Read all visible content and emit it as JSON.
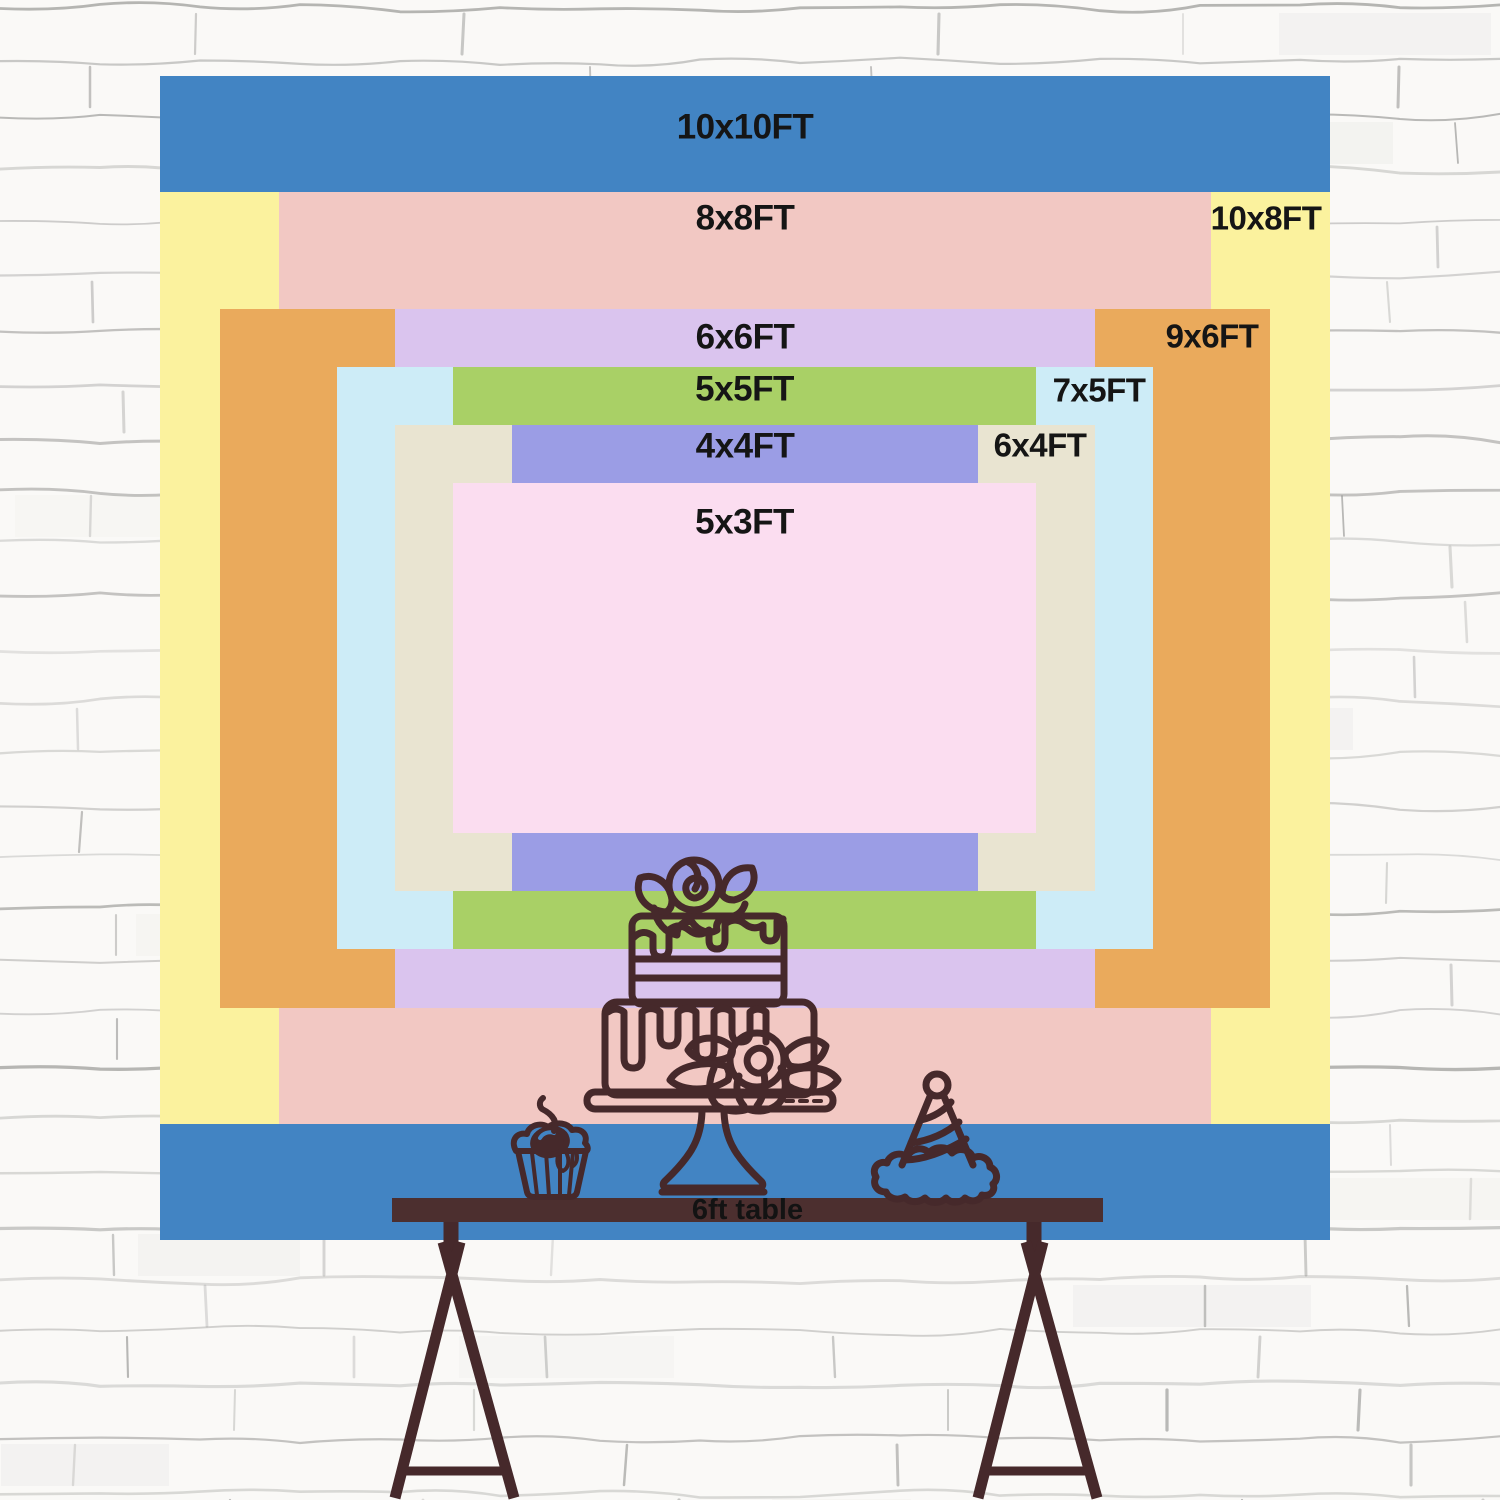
{
  "backdrop": {
    "layers": [
      {
        "name": "10x10ft",
        "label": "10x10FT",
        "color": "#4284c3",
        "label_position": "top-center"
      },
      {
        "name": "10x8ft",
        "label": "10x8FT",
        "color": "#fbf29e",
        "label_position": "top-right"
      },
      {
        "name": "8x8ft",
        "label": "8x8FT",
        "color": "#f2c8c3",
        "label_position": "top-center"
      },
      {
        "name": "9x6ft",
        "label": "9x6FT",
        "color": "#eaaa5c",
        "label_position": "top-right"
      },
      {
        "name": "6x6ft",
        "label": "6x6FT",
        "color": "#dac4ee",
        "label_position": "top-center"
      },
      {
        "name": "7x5ft",
        "label": "7x5FT",
        "color": "#cdecf7",
        "label_position": "top-right"
      },
      {
        "name": "5x5ft",
        "label": "5x5FT",
        "color": "#a9d066",
        "label_position": "top-center"
      },
      {
        "name": "6x4ft",
        "label": "6x4FT",
        "color": "#e9e4d1",
        "label_position": "top-right"
      },
      {
        "name": "4x4ft",
        "label": "4x4FT",
        "color": "#9b9de5",
        "label_position": "top-center"
      },
      {
        "name": "5x3ft",
        "label": "5x3FT",
        "color": "#fbddf0",
        "label_position": "top-center"
      }
    ]
  },
  "table": {
    "label": "6ft table",
    "surface_color": "#4c2f2f"
  },
  "illustration": {
    "ink_color": "#46292b",
    "items": [
      "two-tier-cake-on-stand",
      "cupcake-with-cherry",
      "party-hat",
      "trestle-legs"
    ]
  },
  "wall": {
    "base_color": "#faf9f7",
    "mortar_color": "#8e8e8c"
  }
}
